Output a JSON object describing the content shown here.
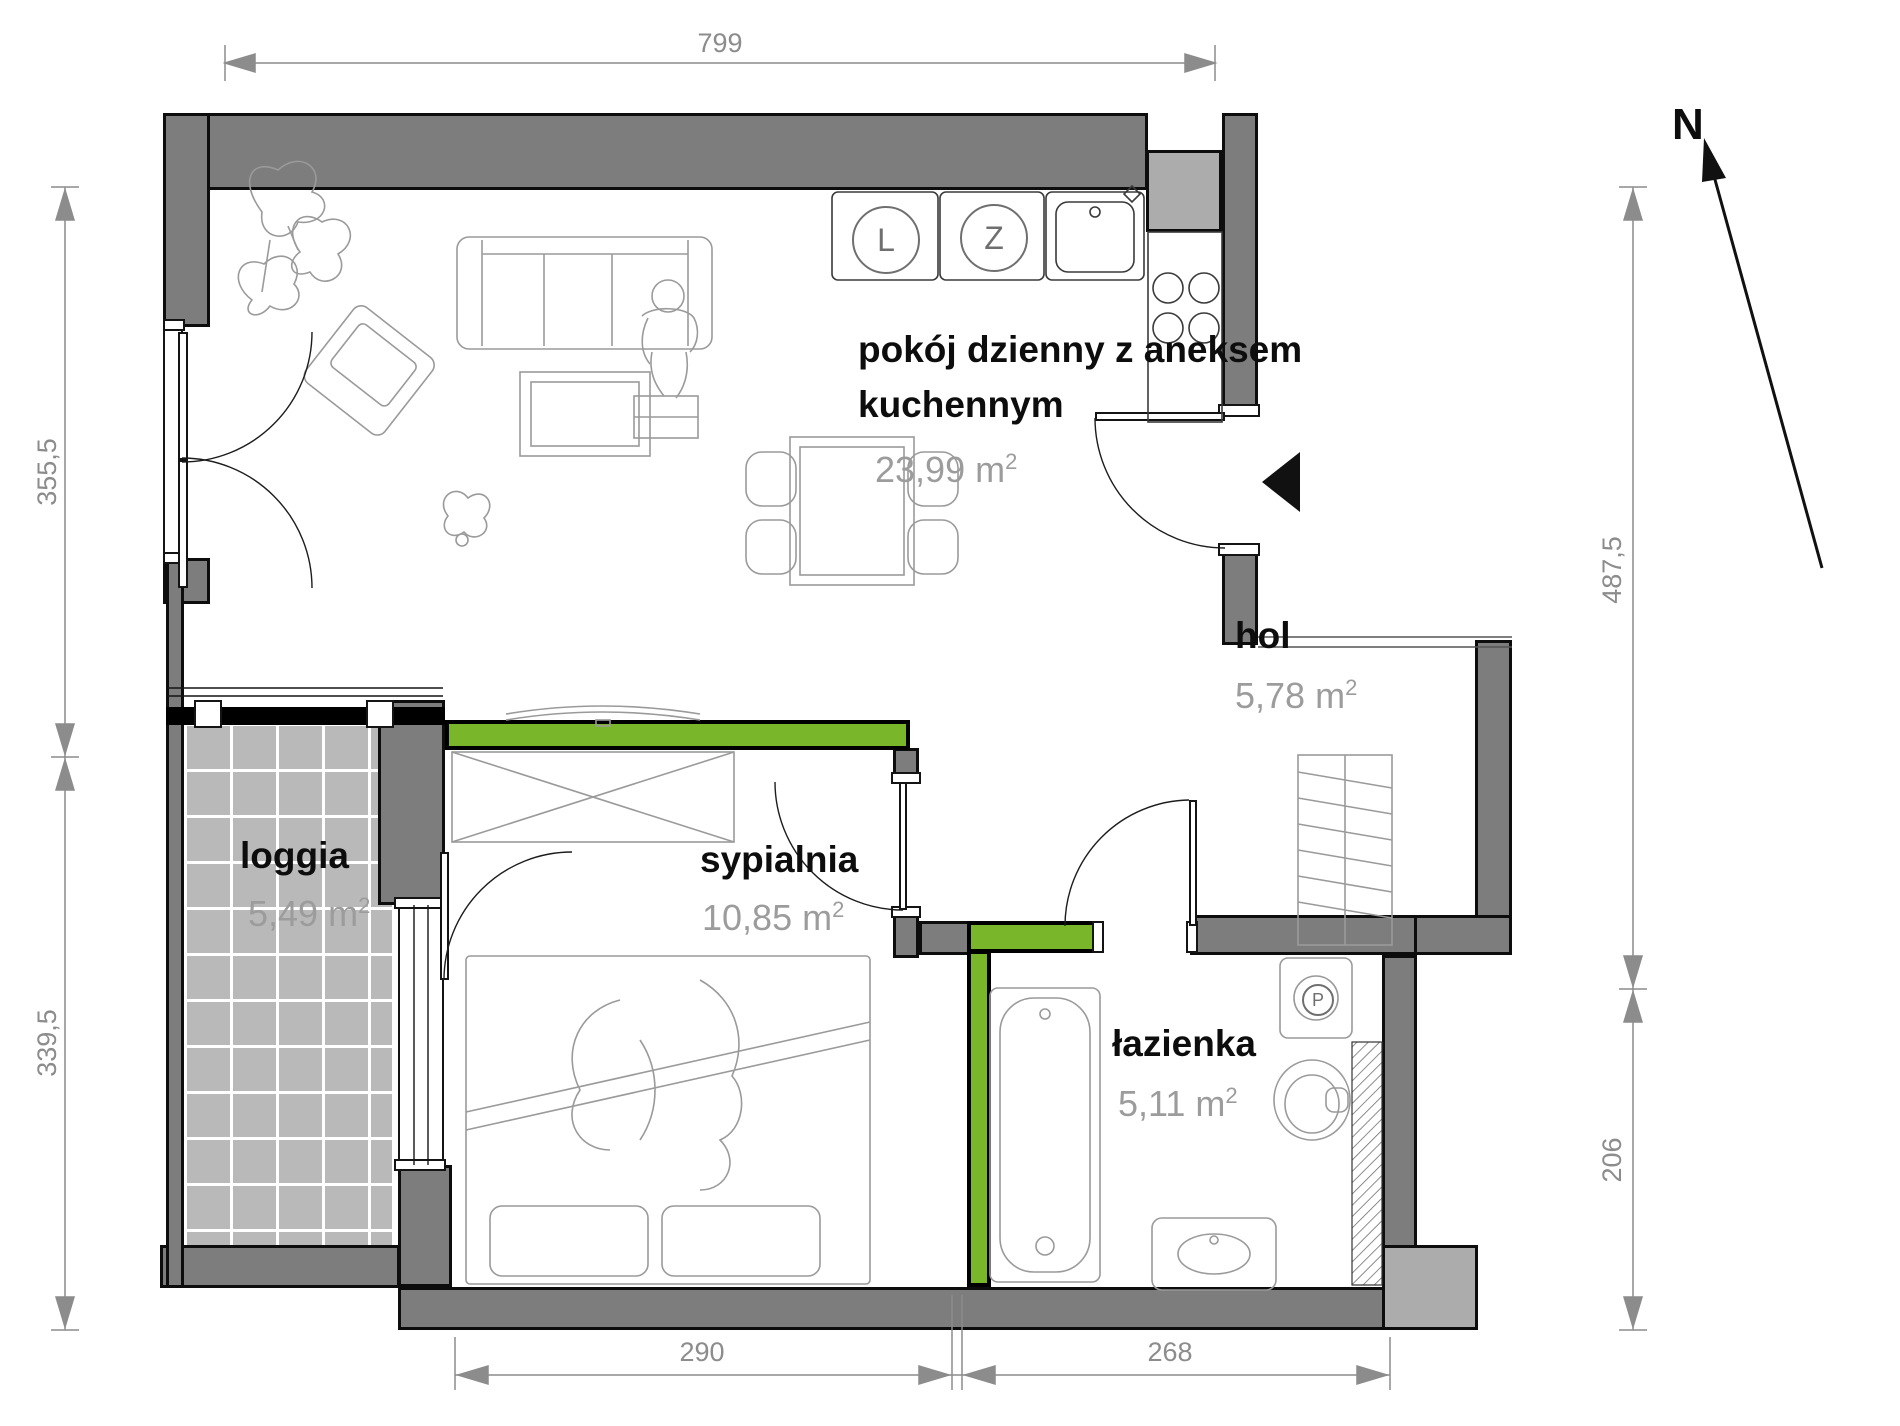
{
  "plan_title": "apartment floor plan",
  "rooms": [
    {
      "id": "living",
      "name": "pokój dzienny z aneksem kuchennym",
      "area": "23,99"
    },
    {
      "id": "hol",
      "name": "hol",
      "area": "5,78"
    },
    {
      "id": "loggia",
      "name": "loggia",
      "area": "5,49"
    },
    {
      "id": "sypialnia",
      "name": "sypialnia",
      "area": "10,85"
    },
    {
      "id": "lazienka",
      "name": "łazienka",
      "area": "5,11"
    }
  ],
  "area_unit": {
    "base": "m",
    "exp": "2"
  },
  "dimensions": {
    "top": "799",
    "left_upper": "355,5",
    "left_lower": "339,5",
    "right_upper": "487,5",
    "right_lower": "206",
    "bottom_left": "290",
    "bottom_right": "268"
  },
  "compass": {
    "north_label": "N"
  },
  "appliances": {
    "fridge": "L",
    "dishwasher": "Z",
    "washing_machine": "P"
  },
  "colors": {
    "wall": "#7d7d7d",
    "wall_light": "#acacac",
    "accent_green": "#7ab629",
    "loggia_tile": "#b9b9b9",
    "dimension_gray": "#8c8c8c",
    "area_text_gray": "#9c9c9c"
  }
}
